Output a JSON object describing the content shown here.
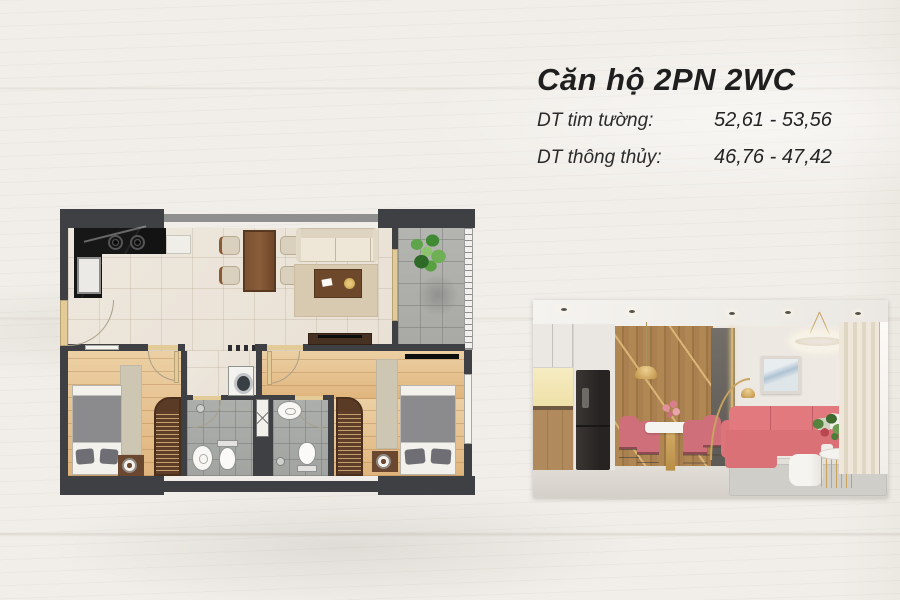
{
  "header": {
    "title": "Căn hộ 2PN 2WC",
    "specs": [
      {
        "label": "DT tim tường:",
        "value": "52,61 - 53,56"
      },
      {
        "label": "DT thông thủy:",
        "value": "46,76 - 47,42"
      }
    ]
  },
  "colors": {
    "background": "#f1eee9",
    "text": "#1f1f1f",
    "plan_wall": "#3f4043",
    "plan_door": "#e2cb96",
    "gold": "#c9a35f",
    "sofa_pink": "#df777d"
  }
}
